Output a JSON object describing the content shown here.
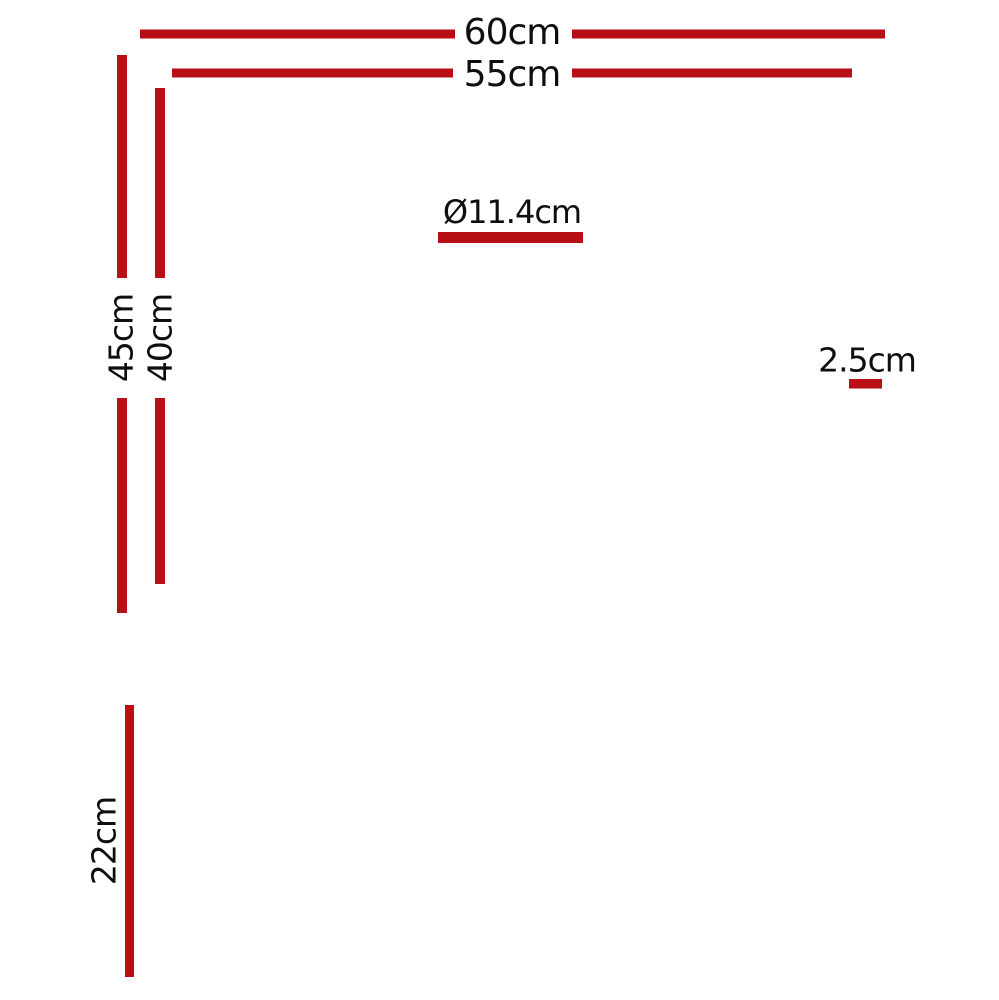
{
  "colors": {
    "dimension_red": "#b70f15",
    "line_black": "#141414"
  },
  "top_view": {
    "outer_width": "60cm",
    "inner_width": "55cm",
    "outer_height": "45cm",
    "inner_height": "40cm",
    "drain_diameter": "Ø11.4cm",
    "edge_depth": "2.5cm"
  },
  "side_view": {
    "depth": "22cm"
  }
}
